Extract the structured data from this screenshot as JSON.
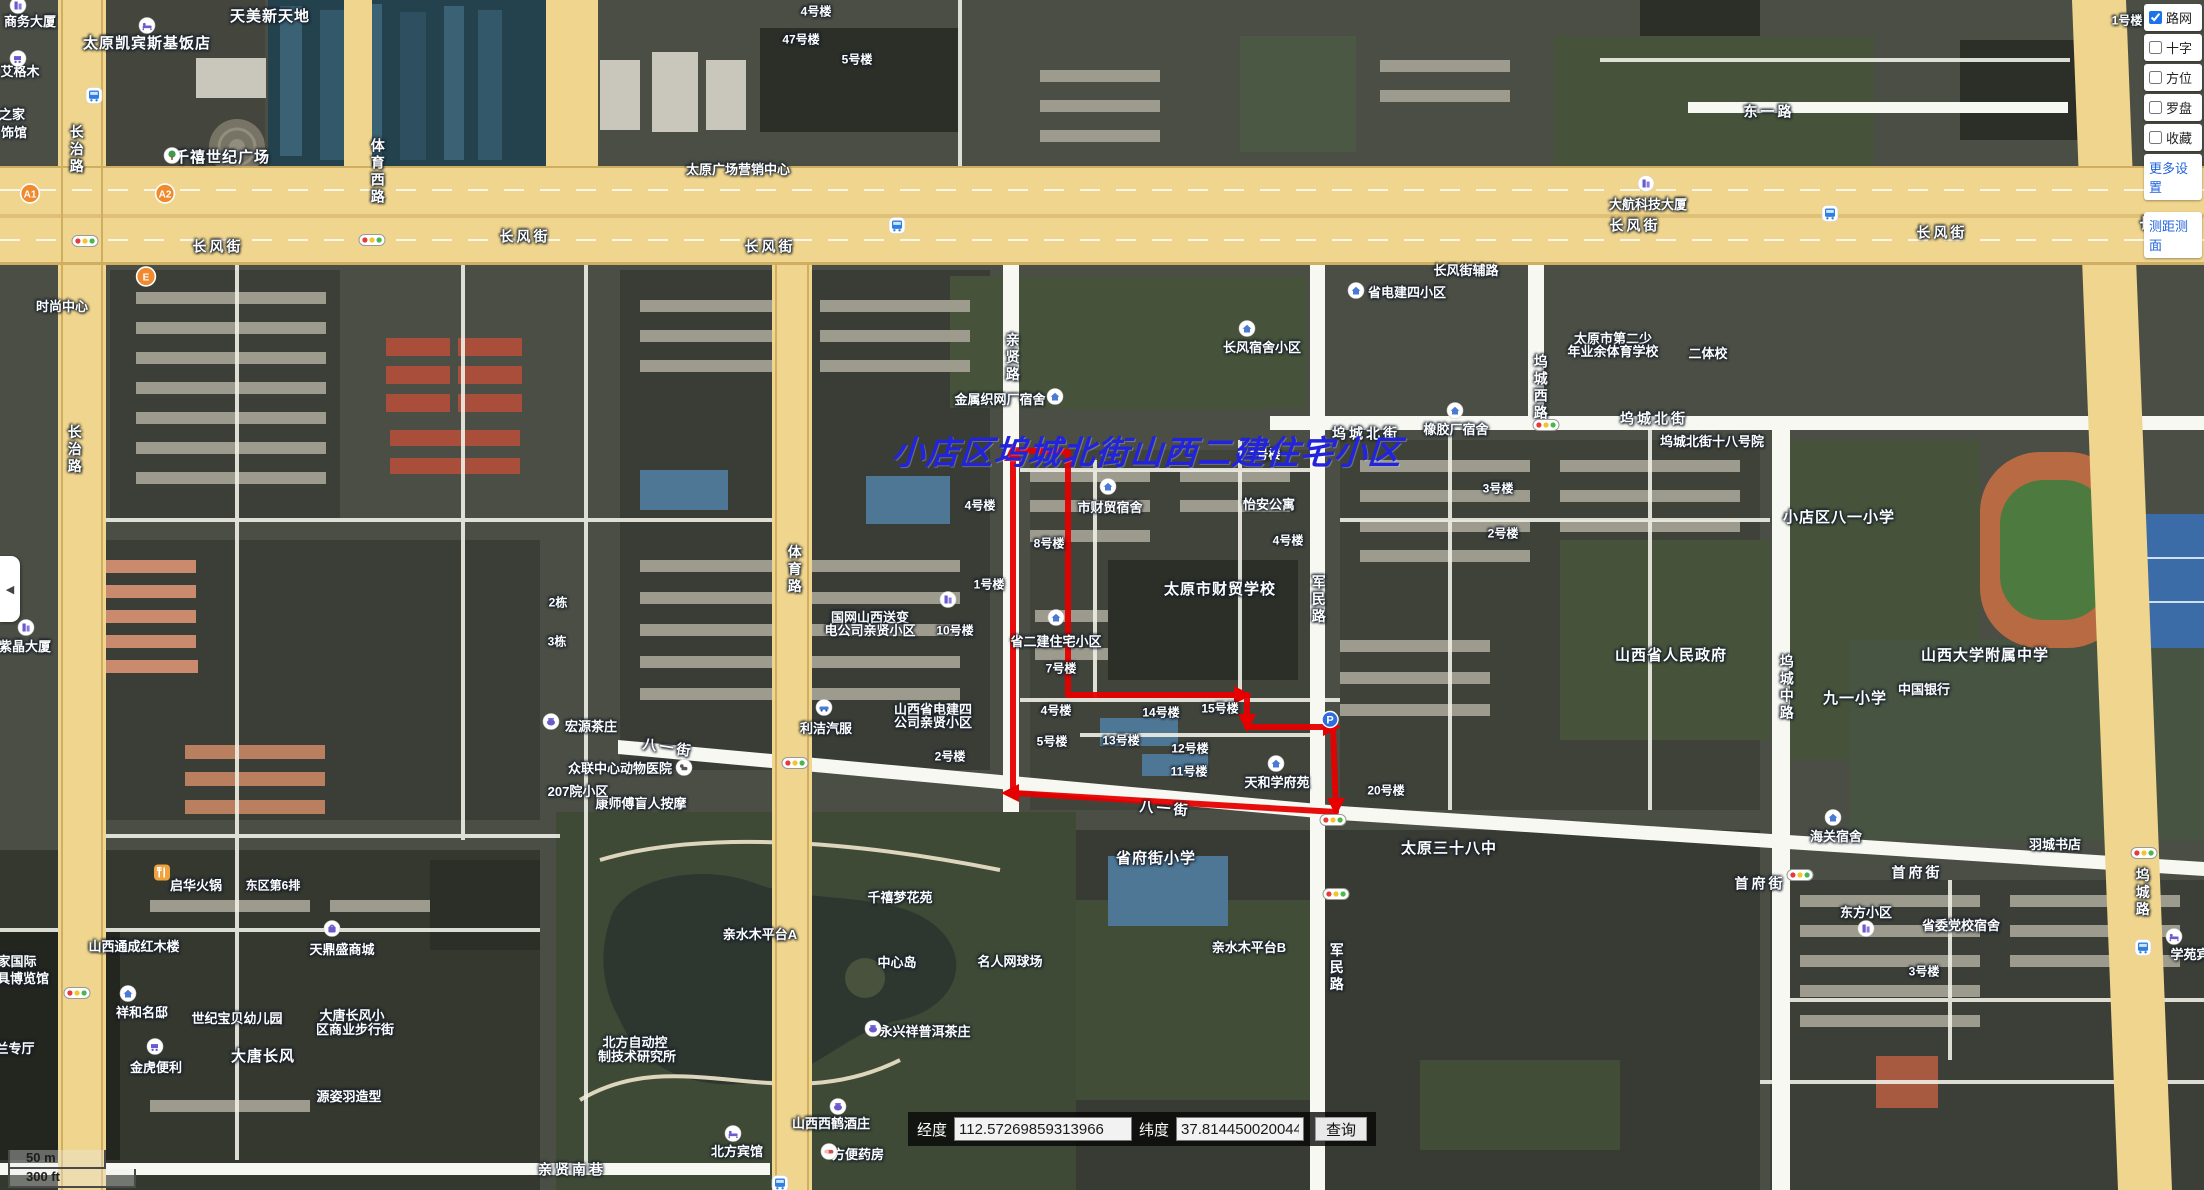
{
  "overlay_title": {
    "text": "小店区坞城北街山西二建住宅小区",
    "color": "#2124dc"
  },
  "controls": {
    "layers": [
      {
        "label": "路网",
        "checked": true
      },
      {
        "label": "十字",
        "checked": false
      },
      {
        "label": "方位",
        "checked": false
      },
      {
        "label": "罗盘",
        "checked": false
      },
      {
        "label": "收藏",
        "checked": false
      }
    ],
    "more_settings_label": "更多设置",
    "measure_label": "测距测面",
    "accent_color": "#1a73e8"
  },
  "coordbar": {
    "lng_label": "经度",
    "lng_value": "112.57269859313966",
    "lat_label": "纬度",
    "lat_value": "37.8144500200445",
    "query_label": "查询"
  },
  "scalebar": {
    "metric": "50 m",
    "imperial": "300 ft"
  },
  "collapse_tab": {
    "glyph": "◀"
  },
  "map": {
    "boundary_color": "#e60000",
    "boundary_points": "1013,450 1013,793 1336,812 1333,727 1247,727 1247,695 1068,695 1068,452",
    "boundary_arrows": [
      "1013,443 1004,461 1022,461",
      "1001,793 1019,784 1019,802",
      "1252,695 1234,686 1234,704",
      "1247,732 1238,714 1256,714",
      "1341,727 1323,718 1323,736",
      "1336,816 1327,798 1345,798"
    ],
    "labels": [
      {
        "t": "长风街",
        "x": 218,
        "y": 247,
        "k": "road"
      },
      {
        "t": "长风街",
        "x": 525,
        "y": 237,
        "k": "road"
      },
      {
        "t": "长风街",
        "x": 770,
        "y": 247,
        "k": "road"
      },
      {
        "t": "长风街",
        "x": 1635,
        "y": 226,
        "k": "road"
      },
      {
        "t": "长风街",
        "x": 1942,
        "y": 233,
        "k": "road"
      },
      {
        "t": "长风街",
        "x": 2165,
        "y": 224,
        "k": "road"
      },
      {
        "t": "长风街辅路",
        "x": 1466,
        "y": 271,
        "k": "poi"
      },
      {
        "t": "坞城北街",
        "x": 1366,
        "y": 434,
        "k": "road"
      },
      {
        "t": "坞城北街",
        "x": 1654,
        "y": 419,
        "k": "road"
      },
      {
        "t": "东一路",
        "x": 1769,
        "y": 112,
        "k": "road"
      },
      {
        "t": "八一街",
        "x": 668,
        "y": 748,
        "k": "road",
        "r": 9
      },
      {
        "t": "八一街",
        "x": 1165,
        "y": 809,
        "k": "road",
        "r": 5
      },
      {
        "t": "首府街",
        "x": 1760,
        "y": 884,
        "k": "road"
      },
      {
        "t": "首府街",
        "x": 1917,
        "y": 873,
        "k": "road"
      },
      {
        "t": "亲贤南巷",
        "x": 572,
        "y": 1170,
        "k": "road"
      },
      {
        "t": "长治路",
        "x": 76,
        "y": 150,
        "k": "vert"
      },
      {
        "t": "长治路",
        "x": 74,
        "y": 450,
        "k": "vert"
      },
      {
        "t": "体育西路",
        "x": 377,
        "y": 172,
        "k": "vert"
      },
      {
        "t": "体育路",
        "x": 794,
        "y": 570,
        "k": "vert"
      },
      {
        "t": "亲贤路",
        "x": 1012,
        "y": 358,
        "k": "vert"
      },
      {
        "t": "军民路",
        "x": 1318,
        "y": 600,
        "k": "vert"
      },
      {
        "t": "军民路",
        "x": 1336,
        "y": 968,
        "k": "vert"
      },
      {
        "t": "坞城西路",
        "x": 1540,
        "y": 388,
        "k": "vert"
      },
      {
        "t": "坞城中路",
        "x": 1786,
        "y": 688,
        "k": "vert"
      },
      {
        "t": "坞城路",
        "x": 2142,
        "y": 893,
        "k": "vert"
      },
      {
        "t": "商务大厦",
        "x": 30,
        "y": 22,
        "k": "poi"
      },
      {
        "t": "天美新天地",
        "x": 270,
        "y": 17,
        "k": "big"
      },
      {
        "t": "太原凯宾斯基饭店",
        "x": 147,
        "y": 44,
        "k": "big"
      },
      {
        "t": "艾格木",
        "x": 20,
        "y": 72,
        "k": "poi"
      },
      {
        "t": "之家",
        "x": 12,
        "y": 115,
        "k": "poi"
      },
      {
        "t": "饰馆",
        "x": 14,
        "y": 133,
        "k": "poi"
      },
      {
        "t": "千禧世纪广场",
        "x": 222,
        "y": 158,
        "k": "big"
      },
      {
        "t": "太原广场营销中心",
        "x": 738,
        "y": 170,
        "k": "poi"
      },
      {
        "t": "时尚中心",
        "x": 62,
        "y": 307,
        "k": "poi"
      },
      {
        "t": "4号楼",
        "x": 816,
        "y": 12,
        "k": "unit"
      },
      {
        "t": "47号楼",
        "x": 801,
        "y": 40,
        "k": "unit"
      },
      {
        "t": "5号楼",
        "x": 857,
        "y": 60,
        "k": "unit"
      },
      {
        "t": "1号楼",
        "x": 2127,
        "y": 21,
        "k": "unit"
      },
      {
        "t": "大航科技大厦",
        "x": 1648,
        "y": 205,
        "k": "poi"
      },
      {
        "t": "省电建四小区",
        "x": 1407,
        "y": 293,
        "k": "poi"
      },
      {
        "t": "长风宿舍小区",
        "x": 1262,
        "y": 348,
        "k": "poi"
      },
      {
        "t": "太原市第二少",
        "x": 1613,
        "y": 339,
        "k": "poi"
      },
      {
        "t": "年业余体育学校",
        "x": 1613,
        "y": 352,
        "k": "poi"
      },
      {
        "t": "二体校",
        "x": 1708,
        "y": 354,
        "k": "poi"
      },
      {
        "t": "橡胶厂宿舍",
        "x": 1456,
        "y": 430,
        "k": "poi"
      },
      {
        "t": "3号楼",
        "x": 1498,
        "y": 489,
        "k": "unit"
      },
      {
        "t": "2号楼",
        "x": 1503,
        "y": 534,
        "k": "unit"
      },
      {
        "t": "坞城北街十八号院",
        "x": 1712,
        "y": 442,
        "k": "poi"
      },
      {
        "t": "金属织网厂宿舍",
        "x": 1000,
        "y": 400,
        "k": "poi"
      },
      {
        "t": "市财贸宿舍",
        "x": 1110,
        "y": 508,
        "k": "poi"
      },
      {
        "t": "怡安公寓",
        "x": 1269,
        "y": 505,
        "k": "poi"
      },
      {
        "t": "1号楼",
        "x": 1265,
        "y": 455,
        "k": "unit"
      },
      {
        "t": "4号楼",
        "x": 1288,
        "y": 541,
        "k": "unit"
      },
      {
        "t": "太原市财贸学校",
        "x": 1220,
        "y": 590,
        "k": "big"
      },
      {
        "t": "8号楼",
        "x": 1049,
        "y": 544,
        "k": "unit"
      },
      {
        "t": "4号楼",
        "x": 980,
        "y": 506,
        "k": "unit"
      },
      {
        "t": "1号楼",
        "x": 989,
        "y": 585,
        "k": "unit"
      },
      {
        "t": "10号楼",
        "x": 955,
        "y": 631,
        "k": "unit"
      },
      {
        "t": "国网山西送变",
        "x": 870,
        "y": 618,
        "k": "poi"
      },
      {
        "t": "电公司亲贤小区",
        "x": 870,
        "y": 631,
        "k": "poi"
      },
      {
        "t": "省二建住宅小区",
        "x": 1056,
        "y": 642,
        "k": "poi"
      },
      {
        "t": "7号楼",
        "x": 1061,
        "y": 669,
        "k": "unit"
      },
      {
        "t": "4号楼",
        "x": 1056,
        "y": 711,
        "k": "unit"
      },
      {
        "t": "5号楼",
        "x": 1052,
        "y": 742,
        "k": "unit"
      },
      {
        "t": "14号楼",
        "x": 1161,
        "y": 713,
        "k": "unit"
      },
      {
        "t": "15号楼",
        "x": 1220,
        "y": 709,
        "k": "unit"
      },
      {
        "t": "13号楼",
        "x": 1121,
        "y": 741,
        "k": "unit"
      },
      {
        "t": "12号楼",
        "x": 1190,
        "y": 749,
        "k": "unit"
      },
      {
        "t": "11号楼",
        "x": 1189,
        "y": 772,
        "k": "unit"
      },
      {
        "t": "山西省电建四",
        "x": 933,
        "y": 710,
        "k": "poi"
      },
      {
        "t": "公司亲贤小区",
        "x": 933,
        "y": 723,
        "k": "poi"
      },
      {
        "t": "2号楼",
        "x": 950,
        "y": 757,
        "k": "unit"
      },
      {
        "t": "利洁汽服",
        "x": 826,
        "y": 729,
        "k": "poi"
      },
      {
        "t": "宏源茶庄",
        "x": 591,
        "y": 727,
        "k": "poi"
      },
      {
        "t": "众联中心动物医院",
        "x": 620,
        "y": 769,
        "k": "poi"
      },
      {
        "t": "康师傅盲人按摩",
        "x": 641,
        "y": 804,
        "k": "poi"
      },
      {
        "t": "2栋",
        "x": 558,
        "y": 603,
        "k": "unit"
      },
      {
        "t": "3栋",
        "x": 557,
        "y": 642,
        "k": "unit"
      },
      {
        "t": "207院小区",
        "x": 578,
        "y": 792,
        "k": "poi"
      },
      {
        "t": "天和学府苑",
        "x": 1277,
        "y": 783,
        "k": "poi"
      },
      {
        "t": "20号楼",
        "x": 1386,
        "y": 791,
        "k": "unit"
      },
      {
        "t": "太原三十八中",
        "x": 1449,
        "y": 849,
        "k": "big"
      },
      {
        "t": "省府街小学",
        "x": 1156,
        "y": 859,
        "k": "big"
      },
      {
        "t": "亲水木平台B",
        "x": 1249,
        "y": 948,
        "k": "poi"
      },
      {
        "t": "亲水木平台A",
        "x": 760,
        "y": 935,
        "k": "poi"
      },
      {
        "t": "中心岛",
        "x": 897,
        "y": 963,
        "k": "poi"
      },
      {
        "t": "名人网球场",
        "x": 1010,
        "y": 962,
        "k": "poi"
      },
      {
        "t": "千禧梦花苑",
        "x": 900,
        "y": 898,
        "k": "poi"
      },
      {
        "t": "山西省人民政府",
        "x": 1671,
        "y": 656,
        "k": "big"
      },
      {
        "t": "小店区八一小学",
        "x": 1839,
        "y": 518,
        "k": "big"
      },
      {
        "t": "九一小学",
        "x": 1855,
        "y": 699,
        "k": "big"
      },
      {
        "t": "山西大学附属中学",
        "x": 1985,
        "y": 656,
        "k": "big"
      },
      {
        "t": "中国银行",
        "x": 1924,
        "y": 690,
        "k": "poi"
      },
      {
        "t": "海关宿舍",
        "x": 1836,
        "y": 837,
        "k": "poi"
      },
      {
        "t": "羽城书店",
        "x": 2055,
        "y": 845,
        "k": "poi"
      },
      {
        "t": "东方小区",
        "x": 1866,
        "y": 913,
        "k": "poi"
      },
      {
        "t": "省委党校宿舍",
        "x": 1961,
        "y": 926,
        "k": "poi"
      },
      {
        "t": "3号楼",
        "x": 1924,
        "y": 972,
        "k": "unit"
      },
      {
        "t": "学苑宾",
        "x": 2190,
        "y": 955,
        "k": "poi"
      },
      {
        "t": "启华火锅",
        "x": 196,
        "y": 886,
        "k": "poi"
      },
      {
        "t": "东区第6排",
        "x": 273,
        "y": 886,
        "k": "unit"
      },
      {
        "t": "山西通成红木楼",
        "x": 134,
        "y": 947,
        "k": "poi"
      },
      {
        "t": "天鼎盛商城",
        "x": 342,
        "y": 950,
        "k": "poi"
      },
      {
        "t": "祥和名邸",
        "x": 142,
        "y": 1013,
        "k": "poi"
      },
      {
        "t": "世纪宝贝幼儿园",
        "x": 237,
        "y": 1019,
        "k": "poi"
      },
      {
        "t": "大唐长风小",
        "x": 352,
        "y": 1016,
        "k": "poi"
      },
      {
        "t": "区商业步行街",
        "x": 355,
        "y": 1030,
        "k": "poi"
      },
      {
        "t": "大唐长风",
        "x": 263,
        "y": 1057,
        "k": "big"
      },
      {
        "t": "金虎便利",
        "x": 156,
        "y": 1068,
        "k": "poi"
      },
      {
        "t": "源姿羽造型",
        "x": 349,
        "y": 1097,
        "k": "poi"
      },
      {
        "t": "家国际",
        "x": 17,
        "y": 962,
        "k": "poi"
      },
      {
        "t": "具博览馆",
        "x": 23,
        "y": 979,
        "k": "poi"
      },
      {
        "t": "兰专厅",
        "x": 15,
        "y": 1049,
        "k": "poi"
      },
      {
        "t": "北方自动控",
        "x": 635,
        "y": 1043,
        "k": "poi"
      },
      {
        "t": "制技术研究所",
        "x": 637,
        "y": 1057,
        "k": "poi"
      },
      {
        "t": "永兴祥普洱茶庄",
        "x": 925,
        "y": 1032,
        "k": "poi"
      },
      {
        "t": "山西西鹤酒庄",
        "x": 831,
        "y": 1124,
        "k": "poi"
      },
      {
        "t": "北方宾馆",
        "x": 737,
        "y": 1152,
        "k": "poi"
      },
      {
        "t": "方便药房",
        "x": 858,
        "y": 1155,
        "k": "poi"
      },
      {
        "t": "紫晶大厦",
        "x": 25,
        "y": 647,
        "k": "poi"
      }
    ],
    "icons": [
      {
        "t": "home",
        "x": 1108,
        "y": 489
      },
      {
        "t": "home",
        "x": 1056,
        "y": 620
      },
      {
        "t": "home",
        "x": 1247,
        "y": 331
      },
      {
        "t": "home",
        "x": 1356,
        "y": 293
      },
      {
        "t": "home",
        "x": 1455,
        "y": 413
      },
      {
        "t": "home",
        "x": 1276,
        "y": 766
      },
      {
        "t": "home",
        "x": 128,
        "y": 996
      },
      {
        "t": "home",
        "x": 1833,
        "y": 820
      },
      {
        "t": "home",
        "x": 1055,
        "y": 399
      },
      {
        "t": "building",
        "x": 18,
        "y": 8
      },
      {
        "t": "building",
        "x": 948,
        "y": 602
      },
      {
        "t": "building",
        "x": 1866,
        "y": 931
      },
      {
        "t": "building",
        "x": 1646,
        "y": 186
      },
      {
        "t": "building",
        "x": 26,
        "y": 630
      },
      {
        "t": "hotel",
        "x": 147,
        "y": 28
      },
      {
        "t": "hotel",
        "x": 733,
        "y": 1136
      },
      {
        "t": "hotel",
        "x": 2174,
        "y": 939
      },
      {
        "t": "bag",
        "x": 332,
        "y": 931
      },
      {
        "t": "cart",
        "x": 18,
        "y": 61
      },
      {
        "t": "cart",
        "x": 155,
        "y": 1049
      },
      {
        "t": "tea",
        "x": 873,
        "y": 1031
      },
      {
        "t": "tea",
        "x": 838,
        "y": 1109
      },
      {
        "t": "tea",
        "x": 551,
        "y": 724
      },
      {
        "t": "food",
        "x": 162,
        "y": 875
      },
      {
        "t": "pill",
        "x": 829,
        "y": 1154
      },
      {
        "t": "tree",
        "x": 172,
        "y": 158
      },
      {
        "t": "car",
        "x": 824,
        "y": 710
      },
      {
        "t": "dog",
        "x": 684,
        "y": 770
      },
      {
        "t": "bus",
        "x": 94,
        "y": 98
      },
      {
        "t": "bus",
        "x": 897,
        "y": 228
      },
      {
        "t": "bus",
        "x": 1830,
        "y": 216
      },
      {
        "t": "bus",
        "x": 2143,
        "y": 950
      },
      {
        "t": "bus",
        "x": 780,
        "y": 1186
      },
      {
        "t": "traffic",
        "x": 85,
        "y": 243
      },
      {
        "t": "traffic",
        "x": 372,
        "y": 242
      },
      {
        "t": "traffic",
        "x": 77,
        "y": 995
      },
      {
        "t": "traffic",
        "x": 795,
        "y": 765
      },
      {
        "t": "traffic",
        "x": 1546,
        "y": 427
      },
      {
        "t": "traffic",
        "x": 1800,
        "y": 877
      },
      {
        "t": "traffic",
        "x": 2144,
        "y": 855
      },
      {
        "t": "traffic",
        "x": 1333,
        "y": 822
      },
      {
        "t": "traffic",
        "x": 1336,
        "y": 896
      },
      {
        "t": "parking",
        "x": 1330,
        "y": 722
      },
      {
        "t": "marker",
        "x": 30,
        "y": 196,
        "txt": "A1"
      },
      {
        "t": "marker",
        "x": 165,
        "y": 196,
        "txt": "A2"
      },
      {
        "t": "marker",
        "x": 146,
        "y": 279,
        "txt": "E"
      }
    ]
  }
}
